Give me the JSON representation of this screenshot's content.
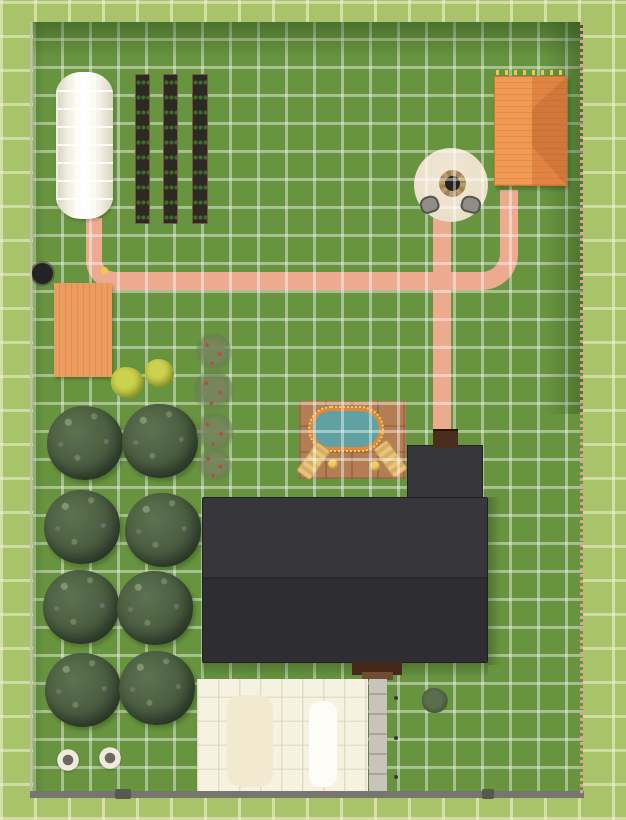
{
  "app": {
    "name": "Garden plan top-down render",
    "view": "top-down",
    "grid_visible": true
  },
  "colors": {
    "outer-grass": "#a9c36a",
    "inner-grass": "#68943f",
    "path": "#ecaa8f",
    "deck": "#ec9c5e",
    "shed-roof": "#f09a56",
    "shed-roof-dark": "#e08343",
    "house-roof": "#36363b",
    "house-roof-lower": "#2e2e32",
    "chimney": "#4a2d1d",
    "porch": "#44291a",
    "porch-step": "#6f4d33",
    "garage": "#f6f2e2",
    "walkway": "#c8c4bb",
    "pool-patio": "#b47e55",
    "pool-water": "#60a1a3",
    "pool-rim": "#e1883d",
    "pool-light": "#f2ce5e",
    "firepit-patio": "#eadfc9",
    "firepit-stone": "#ba9b6b",
    "firepit-coal": "#26211b",
    "tree-dark": "#40533a",
    "tree-light": "#5d7251",
    "fruit-tree": "#76855f",
    "shrub-yellow": "#b6c03e",
    "bed-soil": "#2c2822",
    "bed-frame": "#7d5640",
    "bed-plant": "#3f6b2f",
    "fence-dark": "#76766e",
    "fence-light": "#bdbdb2",
    "flower-pink": "#ea9b93",
    "chair-gray": "#8e8e86",
    "well-black": "#232323"
  },
  "scene": {
    "objects": {
      "lawn": {
        "label": "Lawn with planning grid"
      },
      "greenhouse": {
        "label": "White greenhouse tunnel",
        "count": 1
      },
      "gardenBed": {
        "label": "Raised garden bed with seedlings",
        "count": 3
      },
      "shed": {
        "label": "Shed with terracotta hip roof",
        "count": 1
      },
      "firepit": {
        "label": "Fire pit on round gravel patio",
        "count": 1
      },
      "firepitChair": {
        "label": "Fire pit chair",
        "count": 2
      },
      "path": {
        "label": "Pink garden path",
        "segments": 3
      },
      "deck": {
        "label": "Orange timber deck",
        "count": 1
      },
      "well": {
        "label": "Round black well",
        "count": 1
      },
      "poolPatio": {
        "label": "Tiled pool patio",
        "count": 1
      },
      "pool": {
        "label": "Oval pool with perimeter lights",
        "count": 1
      },
      "lounger": {
        "label": "Sun lounger",
        "count": 2
      },
      "sideTable": {
        "label": "Round side table",
        "count": 2
      },
      "house": {
        "label": "House with charcoal roof",
        "count": 1
      },
      "ell": {
        "label": "Rear roof extension",
        "count": 1
      },
      "chimney": {
        "label": "Brick chimney",
        "count": 1
      },
      "porch": {
        "label": "Back porch steps",
        "count": 1
      },
      "garage": {
        "label": "White garage roof",
        "count": 1
      },
      "walkway": {
        "label": "Concrete walkway",
        "count": 1
      },
      "orchardTree": {
        "label": "Orchard tree",
        "count": 8
      },
      "fruitTree": {
        "label": "Young fruit tree",
        "count": 4
      },
      "shrubYellow": {
        "label": "Yellow-green shrub",
        "count": 2
      },
      "bush": {
        "label": "Small shrub",
        "count": 1
      },
      "planter": {
        "label": "Round planter",
        "count": 2
      },
      "fence": {
        "label": "Property fence",
        "sides": [
          "left",
          "right",
          "bottom"
        ]
      },
      "flowerLine": {
        "label": "Flower border along right fence"
      }
    }
  }
}
